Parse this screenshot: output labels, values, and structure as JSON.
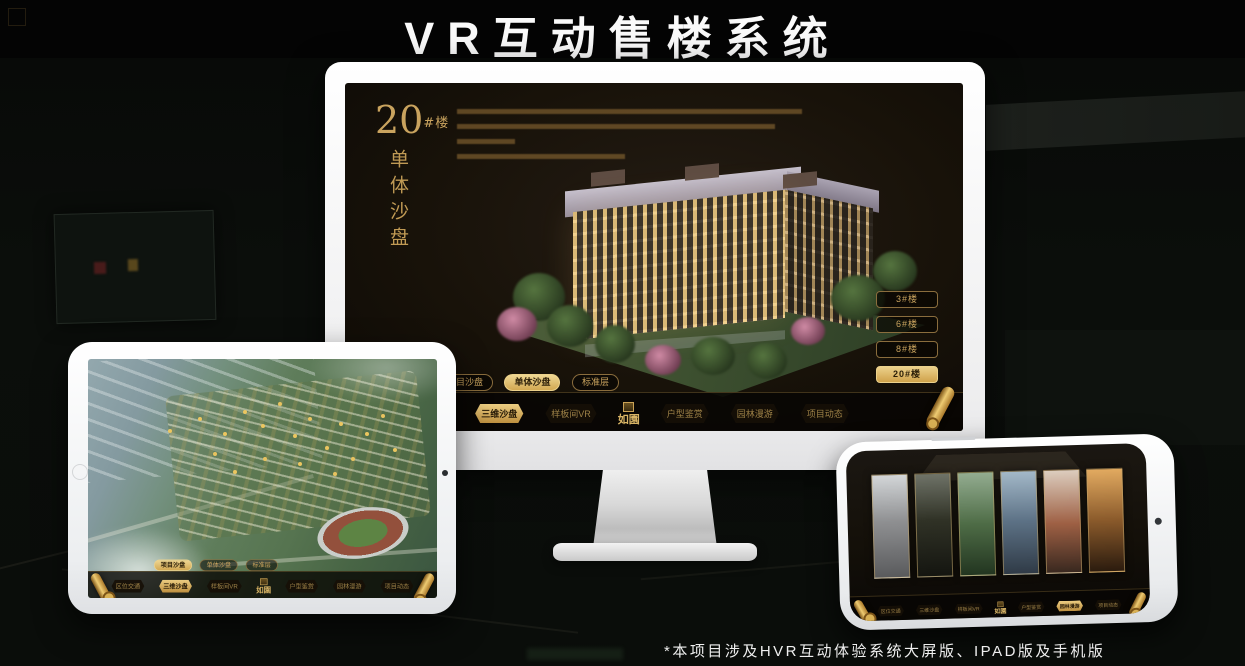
{
  "page": {
    "title": "VR互动售楼系统",
    "footnote": "*本项目涉及HVR互动体验系统大屏版、IPAD版及手机版"
  },
  "colors": {
    "accent_gold": "#cda55c",
    "active_button_gold": "#d2a852",
    "active_text_dark": "#2a1d07",
    "title_white": "#fafafa"
  },
  "app": {
    "logo": "如園",
    "sub_tabs": [
      {
        "label": "项目沙盘"
      },
      {
        "label": "单体沙盘"
      },
      {
        "label": "标准层"
      }
    ],
    "nav_items": [
      {
        "label": "区位交通"
      },
      {
        "label": "三维沙盘"
      },
      {
        "label": "样板间VR"
      },
      {
        "label": "户型鉴赏"
      },
      {
        "label": "园林漫游"
      },
      {
        "label": "项目动态"
      }
    ]
  },
  "monitor": {
    "heading": {
      "number": "20",
      "suffix": "#楼",
      "subtitle": "单体沙盘"
    },
    "building_buttons": [
      {
        "label": "3#楼",
        "active": false
      },
      {
        "label": "6#楼",
        "active": false
      },
      {
        "label": "8#楼",
        "active": false
      },
      {
        "label": "20#楼",
        "active": true
      }
    ],
    "active_sub_tab": "单体沙盘",
    "active_nav_item": "三维沙盘"
  },
  "ipad": {
    "active_sub_tab": "项目沙盘",
    "active_nav_item": "三维沙盘"
  },
  "phone": {
    "active_nav_item": "园林漫游"
  }
}
